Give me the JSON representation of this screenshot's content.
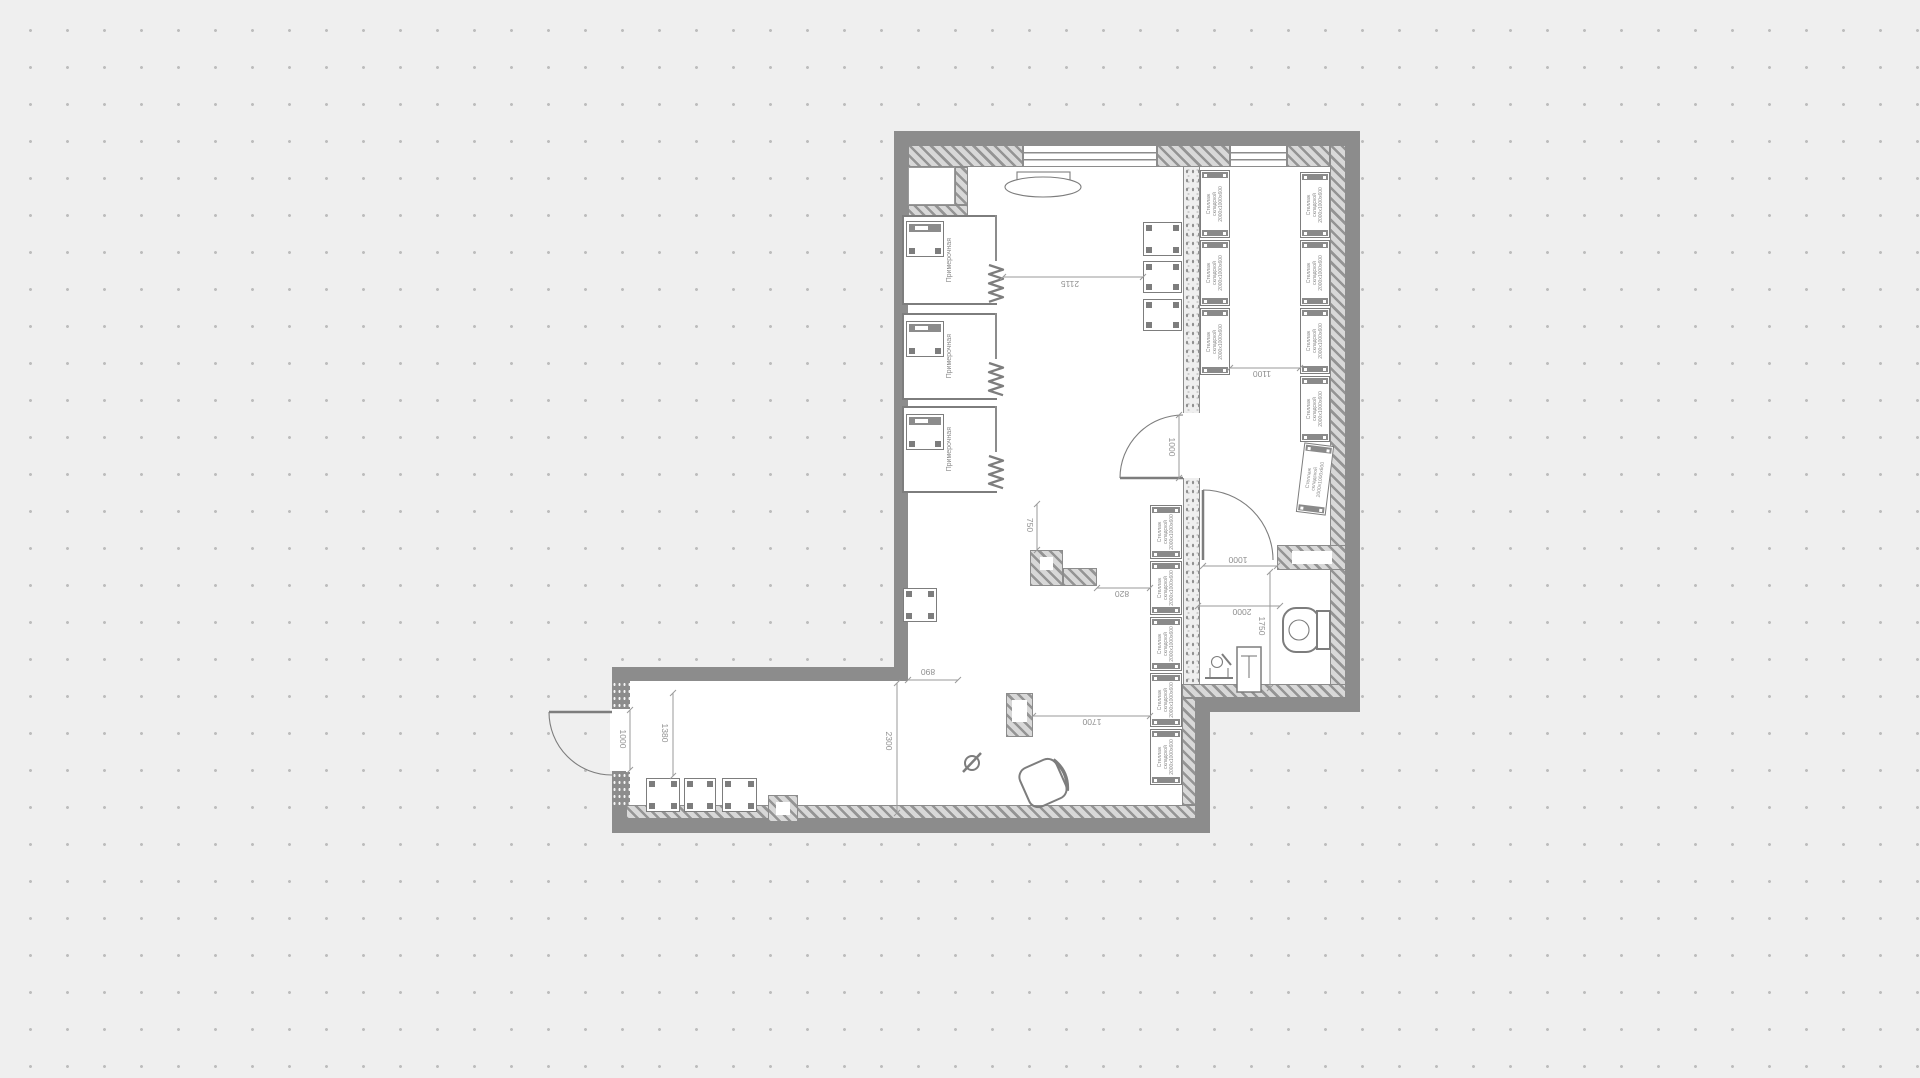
{
  "plan": {
    "texts": {
      "check_table": "Стол для\nпроверки товара",
      "check_table_v": "Стол для\nпроверки товара",
      "counter": "Прилавок",
      "stand": "Стойка",
      "cabinet": "Шкаф\nубор.инв\n540х500",
      "shelf": "Стеллаж\nскладской\n2000х1000х600",
      "fitting": "Примерочная"
    },
    "rects": [
      {
        "cls": "floor",
        "name": "floor-upper",
        "r": [
          908,
          145,
          438,
          553
        ]
      },
      {
        "cls": "floor",
        "name": "floor-wing",
        "r": [
          626,
          681,
          570,
          138
        ]
      },
      {
        "cls": "wall",
        "name": "wall-top",
        "r": [
          894,
          131,
          466,
          14
        ]
      },
      {
        "cls": "wall",
        "name": "wall-right",
        "r": [
          1346,
          131,
          14,
          581
        ]
      },
      {
        "cls": "wall",
        "name": "wall-left",
        "r": [
          894,
          131,
          14,
          550
        ]
      },
      {
        "cls": "wall",
        "name": "wall-bottom-right-section",
        "r": [
          1196,
          698,
          164,
          14
        ]
      },
      {
        "cls": "wall",
        "name": "wall-wing-top",
        "r": [
          612,
          667,
          296,
          14
        ]
      },
      {
        "cls": "wall",
        "name": "wall-wing-left",
        "r": [
          612,
          667,
          14,
          166
        ]
      },
      {
        "cls": "wall",
        "name": "wall-wing-bottom",
        "r": [
          612,
          819,
          598,
          14
        ]
      },
      {
        "cls": "wall",
        "name": "wall-wing-right",
        "r": [
          1196,
          698,
          14,
          121
        ]
      },
      {
        "cls": "floor",
        "name": "entry-door-opening",
        "r": [
          610,
          709,
          18,
          62
        ]
      },
      {
        "cls": "hatch",
        "name": "wall-lining-top-1",
        "r": [
          908,
          145,
          115,
          22
        ]
      },
      {
        "cls": "hatch",
        "name": "wall-lining-top-2",
        "r": [
          1157,
          145,
          73,
          22
        ]
      },
      {
        "cls": "hatch",
        "name": "wall-lining-top-3",
        "r": [
          1287,
          145,
          43,
          22
        ]
      },
      {
        "cls": "hatch",
        "name": "wall-lining-right",
        "r": [
          1330,
          145,
          16,
          553
        ]
      },
      {
        "cls": "hatch",
        "name": "wall-lining-bottom-right",
        "r": [
          1182,
          684,
          164,
          14
        ]
      },
      {
        "cls": "hatch",
        "name": "wall-lining-wing-bottom",
        "r": [
          626,
          805,
          570,
          14
        ]
      },
      {
        "cls": "hatch",
        "name": "wall-lining-wing-right",
        "r": [
          1182,
          698,
          14,
          107
        ]
      },
      {
        "cls": "hatch",
        "name": "vestibule-wall-right",
        "r": [
          955,
          167,
          13,
          38
        ]
      },
      {
        "cls": "hatch",
        "name": "vestibule-wall-bottom",
        "r": [
          908,
          205,
          60,
          17
        ]
      },
      {
        "cls": "hatch",
        "name": "toilet-wall",
        "r": [
          1277,
          545,
          69,
          25
        ]
      },
      {
        "cls": "floor",
        "name": "toilet-wall-inset",
        "r": [
          1292,
          551,
          40,
          13
        ]
      },
      {
        "cls": "hatch",
        "name": "column-check-vertical",
        "r": [
          1030,
          550,
          33,
          36
        ]
      },
      {
        "cls": "hatch",
        "name": "column-check-arm",
        "r": [
          1063,
          568,
          34,
          18
        ]
      },
      {
        "cls": "floor",
        "name": "column-check-hole",
        "r": [
          1040,
          557,
          13,
          13
        ]
      },
      {
        "cls": "hatch",
        "name": "column-counter",
        "r": [
          1006,
          693,
          27,
          44
        ]
      },
      {
        "cls": "floor",
        "name": "column-counter-hole",
        "r": [
          1012,
          700,
          15,
          22
        ]
      },
      {
        "cls": "hatch",
        "name": "column-wing",
        "r": [
          768,
          795,
          30,
          27
        ]
      },
      {
        "cls": "floor",
        "name": "column-wing-hole",
        "r": [
          776,
          802,
          14,
          13
        ]
      },
      {
        "cls": "speckle",
        "name": "partition-upper",
        "r": [
          1183,
          167,
          17,
          246
        ]
      },
      {
        "cls": "speckle",
        "name": "partition-lower",
        "r": [
          1183,
          478,
          17,
          206
        ]
      },
      {
        "cls": "pier",
        "name": "entry-pier-top",
        "r": [
          612,
          681,
          18,
          28
        ]
      },
      {
        "cls": "pier",
        "name": "entry-pier-bottom",
        "r": [
          612,
          772,
          18,
          33
        ]
      },
      {
        "cls": "window",
        "name": "window-1",
        "r": [
          1023,
          145,
          134,
          22
        ]
      },
      {
        "cls": "window",
        "name": "window-2",
        "r": [
          1230,
          145,
          57,
          22
        ]
      },
      {
        "cls": "niche",
        "name": "vestibule-niche",
        "r": [
          908,
          167,
          47,
          38
        ]
      }
    ],
    "fitting_rooms": [
      {
        "y": 215,
        "h": 90
      },
      {
        "y": 313,
        "h": 87
      },
      {
        "y": 406,
        "h": 87
      }
    ],
    "tables": [
      {
        "r": [
          906,
          221,
          38,
          36
        ],
        "bar": 1,
        "name": "fitting-bench"
      },
      {
        "r": [
          906,
          321,
          38,
          36
        ],
        "bar": 1,
        "name": "fitting-bench"
      },
      {
        "r": [
          906,
          414,
          38,
          36
        ],
        "bar": 1,
        "name": "fitting-bench"
      },
      {
        "r": [
          1143,
          222,
          39,
          34
        ],
        "name": "display-table"
      },
      {
        "r": [
          1143,
          261,
          39,
          32
        ],
        "name": "display-table"
      },
      {
        "r": [
          1143,
          299,
          39,
          32
        ],
        "name": "display-table"
      },
      {
        "r": [
          903,
          588,
          34,
          34
        ],
        "name": "check-table-seat"
      },
      {
        "r": [
          646,
          778,
          34,
          34
        ],
        "name": "wing-table"
      },
      {
        "r": [
          684,
          778,
          32,
          34
        ],
        "name": "wing-table"
      },
      {
        "r": [
          722,
          778,
          35,
          34
        ],
        "name": "wing-table"
      }
    ],
    "shelves": [
      {
        "x": 1200,
        "y": 170,
        "w": 30,
        "h": 68
      },
      {
        "x": 1200,
        "y": 240,
        "w": 30,
        "h": 66
      },
      {
        "x": 1200,
        "y": 308,
        "w": 30,
        "h": 67
      },
      {
        "x": 1300,
        "y": 172,
        "w": 30,
        "h": 66
      },
      {
        "x": 1300,
        "y": 240,
        "w": 30,
        "h": 66
      },
      {
        "x": 1300,
        "y": 308,
        "w": 30,
        "h": 66
      },
      {
        "x": 1300,
        "y": 376,
        "w": 30,
        "h": 66
      },
      {
        "x": 1300,
        "y": 444,
        "w": 30,
        "h": 70,
        "rot": 7
      },
      {
        "x": 1150,
        "y": 505,
        "w": 32,
        "h": 54
      },
      {
        "x": 1150,
        "y": 561,
        "w": 32,
        "h": 54
      },
      {
        "x": 1150,
        "y": 617,
        "w": 32,
        "h": 54
      },
      {
        "x": 1150,
        "y": 673,
        "w": 32,
        "h": 54
      },
      {
        "x": 1150,
        "y": 729,
        "w": 32,
        "h": 56
      }
    ],
    "dims": [
      {
        "label": "2115",
        "x1": 1003,
        "y1": 277,
        "x2": 1143,
        "y2": 277,
        "lx": 1070,
        "ly": 284,
        "rot": 180
      },
      {
        "label": "1100",
        "x1": 1230,
        "y1": 368,
        "x2": 1300,
        "y2": 368,
        "lx": 1262,
        "ly": 374,
        "rot": 180
      },
      {
        "label": "750",
        "x1": 1037,
        "y1": 504,
        "x2": 1037,
        "y2": 550,
        "lx": 1030,
        "ly": 525,
        "rot": 90
      },
      {
        "label": "820",
        "x1": 1097,
        "y1": 588,
        "x2": 1150,
        "y2": 588,
        "lx": 1122,
        "ly": 594,
        "rot": 180
      },
      {
        "label": "1000",
        "x1": 1179,
        "y1": 415,
        "x2": 1179,
        "y2": 478,
        "lx": 1172,
        "ly": 447,
        "rot": 90
      },
      {
        "label": "1000",
        "x1": 1203,
        "y1": 566,
        "x2": 1277,
        "y2": 566,
        "lx": 1238,
        "ly": 560,
        "rot": 180
      },
      {
        "label": "2000",
        "x1": 1198,
        "y1": 606,
        "x2": 1280,
        "y2": 606,
        "lx": 1242,
        "ly": 612,
        "rot": 180
      },
      {
        "label": "1750",
        "x1": 1270,
        "y1": 572,
        "x2": 1270,
        "y2": 688,
        "lx": 1262,
        "ly": 626,
        "rot": 90
      },
      {
        "label": "1700",
        "x1": 1033,
        "y1": 716,
        "x2": 1150,
        "y2": 716,
        "lx": 1092,
        "ly": 722,
        "rot": 180
      },
      {
        "label": "890",
        "x1": 908,
        "y1": 680,
        "x2": 958,
        "y2": 680,
        "lx": 928,
        "ly": 672,
        "rot": 180
      },
      {
        "label": "2300",
        "x1": 897,
        "y1": 683,
        "x2": 897,
        "y2": 813,
        "lx": 889,
        "ly": 741,
        "rot": 90
      },
      {
        "label": "1380",
        "x1": 673,
        "y1": 693,
        "x2": 673,
        "y2": 776,
        "lx": 665,
        "ly": 733,
        "rot": 90
      },
      {
        "label": "1000",
        "x1": 630,
        "y1": 710,
        "x2": 630,
        "y2": 770,
        "lx": 623,
        "ly": 739,
        "rot": 90
      }
    ]
  }
}
